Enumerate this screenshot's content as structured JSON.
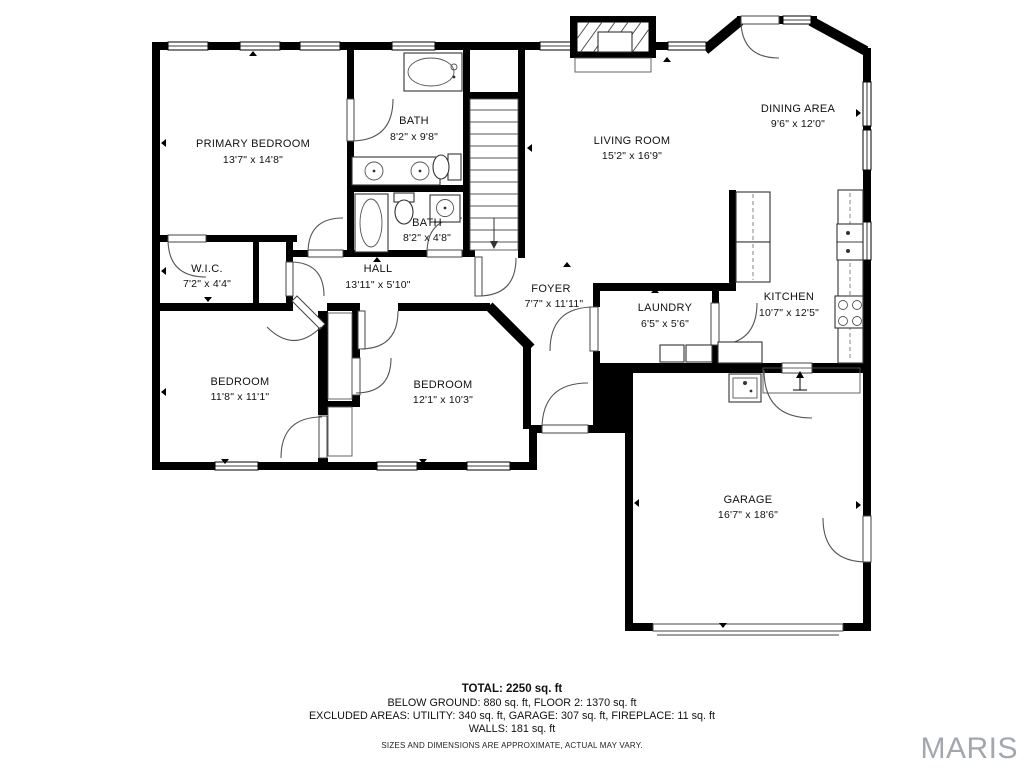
{
  "rooms": {
    "primary_bedroom": {
      "name": "PRIMARY BEDROOM",
      "dims": "13'7\" x 14'8\""
    },
    "bath_upper": {
      "name": "BATH",
      "dims": "8'2\" x 9'8\""
    },
    "bath_lower": {
      "name": "BATH",
      "dims": "8'2\" x 4'8\""
    },
    "wic": {
      "name": "W.I.C.",
      "dims": "7'2\" x 4'4\""
    },
    "hall": {
      "name": "HALL",
      "dims": "13'11\" x 5'10\""
    },
    "bedroom_left": {
      "name": "BEDROOM",
      "dims": "11'8\" x 11'1\""
    },
    "bedroom_right": {
      "name": "BEDROOM",
      "dims": "12'1\" x 10'3\""
    },
    "living_room": {
      "name": "LIVING ROOM",
      "dims": "15'2\" x 16'9\""
    },
    "dining_area": {
      "name": "DINING AREA",
      "dims": "9'6\" x 12'0\""
    },
    "foyer": {
      "name": "FOYER",
      "dims": "7'7\" x 11'11\""
    },
    "laundry": {
      "name": "LAUNDRY",
      "dims": "6'5\" x 5'6\""
    },
    "kitchen": {
      "name": "KITCHEN",
      "dims": "10'7\" x 12'5\""
    },
    "garage": {
      "name": "GARAGE",
      "dims": "16'7\" x 18'6\""
    }
  },
  "footer": {
    "total": "TOTAL: 2250 sq. ft",
    "areas_line1": "BELOW GROUND: 880 sq. ft, FLOOR 2: 1370 sq. ft",
    "areas_line2": "EXCLUDED AREAS: UTILITY: 340 sq. ft, GARAGE: 307 sq. ft, FIREPLACE: 11 sq. ft",
    "areas_line3": "WALLS: 181 sq. ft",
    "disclaimer": "SIZES AND DIMENSIONS ARE APPROXIMATE, ACTUAL MAY VARY."
  },
  "watermark": "MARIS",
  "colors": {
    "wall": "#000000",
    "text": "#111111",
    "watermark": "#a2a8ae"
  }
}
